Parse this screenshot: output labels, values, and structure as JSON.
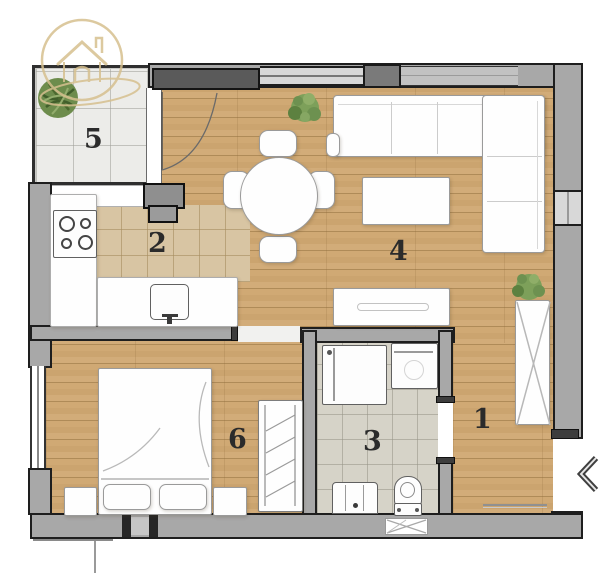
{
  "logo": {
    "icon": "house-in-circle-logo-icon",
    "color": "#d6c08f"
  },
  "colors": {
    "background": "#ffffff",
    "wall_fill": "#a8a8a8",
    "wall_line": "#1e1e1e",
    "wood_floor": "#cda873",
    "balcony_tile": "#ecece9",
    "kitchen_tile": "#d8c5a3",
    "bathroom_tile": "#d6d3c8",
    "furniture": "#ffffff",
    "room_label": "#2b2b2b",
    "plant_green": "#6d8c4c"
  },
  "rooms": [
    {
      "key": "hallway",
      "number": "1"
    },
    {
      "key": "kitchen",
      "number": "2"
    },
    {
      "key": "bathroom",
      "number": "3"
    },
    {
      "key": "living-room",
      "number": "4"
    },
    {
      "key": "balcony",
      "number": "5"
    },
    {
      "key": "bedroom",
      "number": "6"
    }
  ],
  "symbols": {
    "entrance_arrow": "chevron-left",
    "furniture": [
      "corner-sofa",
      "coffee-table",
      "tv-stand",
      "round-dining-table",
      "dining-chairs",
      "kitchen-counter",
      "stove",
      "kitchen-sink",
      "double-bed",
      "pillows",
      "nightstands",
      "radiator",
      "wardrobe",
      "shower",
      "washing-machine",
      "bathroom-sink",
      "toilet",
      "door-mat",
      "potted-plants"
    ]
  }
}
